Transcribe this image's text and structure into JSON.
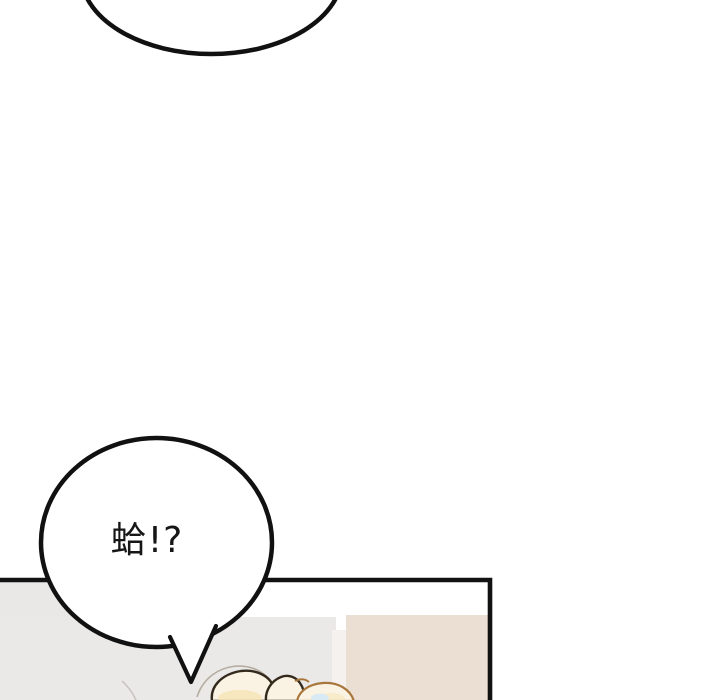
{
  "page": {
    "width": 720,
    "height": 700,
    "background": "#ffffff",
    "type_note": "comic/webtoon panel fragment"
  },
  "bubbles": {
    "top_partial": {
      "text": "",
      "fill": "#ffffff",
      "stroke": "#111111"
    },
    "main": {
      "text": "蛤!?",
      "fill": "#ffffff",
      "stroke": "#111111",
      "text_color": "#161616"
    }
  },
  "panel": {
    "border_color": "#121212",
    "interior": {
      "wall_gray": "#e9e8e7",
      "wall_gray_lower": "#eae9e8",
      "door_strip": "#f4f1ee",
      "wall_beige": "#ebdfd3",
      "backdrop_white": "#ffffff"
    }
  },
  "character": {
    "hair_fill": "#faf3e3",
    "hair_shade": "#f6e4b5",
    "hair_outline_dark": "#33291c",
    "hair_outline_warm": "#a9763b",
    "hair_thin_line": "#b5ac9f",
    "accessory_blue": "#d8eaf4",
    "wisp_line": "#c8c4c0"
  }
}
